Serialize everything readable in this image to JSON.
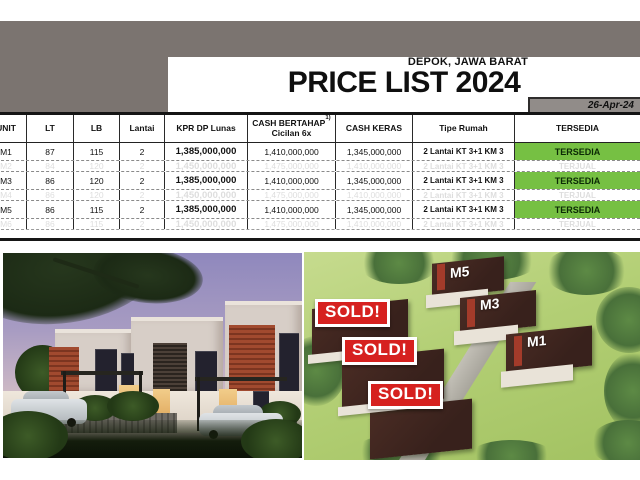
{
  "page": {
    "location": "DEPOK, JAWA BARAT",
    "title": "PRICE LIST 2024",
    "date": "26-Apr-24"
  },
  "table": {
    "headers": {
      "unit": "UNIT",
      "lt": "LT",
      "lb": "LB",
      "lantai": "Lantai",
      "kpr": "KPR DP Lunas",
      "bertahap": "CASH BERTAHAP",
      "bertahap_sup": "1)",
      "bertahap_line2": "Cicilan 6x",
      "keras": "CASH KERAS",
      "tipe": "Tipe Rumah",
      "tersedia": "TERSEDIA"
    },
    "rows": [
      {
        "unit": "M1",
        "lt": "87",
        "lb": "115",
        "lantai": "2",
        "kpr": "1,385,000,000",
        "bertahap": "1,410,000,000",
        "keras": "1,345,000,000",
        "tipe": "2 Lantai KT 3+1 KM 3",
        "status": "TERSEDIA",
        "sold": false
      },
      {
        "unit": "M2",
        "lt": "84",
        "lb": "120",
        "lantai": "2",
        "kpr": "1,450,000,000",
        "bertahap": "1,475,000,000",
        "keras": "1,410,000,000",
        "tipe": "2 Lantai KT 3+1 KM 3",
        "status": "TERJUAL",
        "sold": true
      },
      {
        "unit": "M3",
        "lt": "86",
        "lb": "120",
        "lantai": "2",
        "kpr": "1,385,000,000",
        "bertahap": "1,410,000,000",
        "keras": "1,345,000,000",
        "tipe": "2 Lantai KT 3+1 KM 3",
        "status": "TERSEDIA",
        "sold": false
      },
      {
        "unit": "M4",
        "lt": "86",
        "lb": "120",
        "lantai": "2",
        "kpr": "1,450,000,000",
        "bertahap": "1,475,000,000",
        "keras": "1,410,000,000",
        "tipe": "2 Lantai KT 3+1 KM 3",
        "status": "TERJUAL",
        "sold": true
      },
      {
        "unit": "M5",
        "lt": "86",
        "lb": "115",
        "lantai": "2",
        "kpr": "1,385,000,000",
        "bertahap": "1,410,000,000",
        "keras": "1,345,000,000",
        "tipe": "2 Lantai KT 3+1 KM 3",
        "status": "TERSEDIA",
        "sold": false
      },
      {
        "unit": "M6",
        "lt": "86",
        "lb": "115",
        "lantai": "2",
        "kpr": "1,450,000,000",
        "bertahap": "1,475,000,000",
        "keras": "1,410,000,000",
        "tipe": "2 Lantai KT 3+1 KM 3",
        "status": "TERJUAL",
        "sold": true
      }
    ]
  },
  "site_plan": {
    "unit_labels": [
      "M5",
      "M3",
      "M1"
    ],
    "sold_badges": [
      "SOLD!",
      "SOLD!",
      "SOLD!"
    ]
  },
  "colors": {
    "available_green": "#76c043",
    "sold_red": "#d6211f",
    "band_gray": "#7b7470"
  }
}
